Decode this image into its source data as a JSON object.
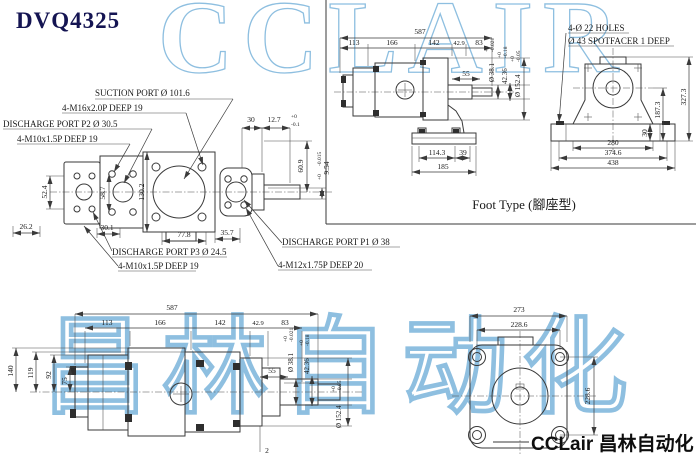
{
  "title": "DVQ4325",
  "watermarks": {
    "top": "CCLAIR",
    "bottom": "昌林自动化"
  },
  "brand": {
    "text": "CCLair 昌林自动化"
  },
  "colors": {
    "line": "#3a3a3a",
    "text": "#1a1a1a",
    "title": "#141452",
    "watermark": "#8ebfe0",
    "brand": "#0e0e0e"
  },
  "front_view": {
    "port_labels": {
      "suction": "SUCTION PORT Ø 101.6",
      "suction_bolts": "4-M16x2.0P DEEP 19",
      "p2": "DISCHARGE PORT P2 Ø 30.5",
      "p2_bolts": "4-M10x1.5P DEEP 19",
      "p3": "DISCHARGE PORT P3 Ø 24.5",
      "p3_bolts": "4-M10x1.5P DEEP 19",
      "p1": "DISCHARGE PORT P1 Ø 38",
      "p1_bolts": "4-M12x1.75P DEEP 20"
    },
    "dims": {
      "w52": "52.4",
      "w58": "58.7",
      "h130": "130.2",
      "w26": "26.2",
      "w30_1": "30.1",
      "w77": "77.8",
      "w35": "35.7",
      "len30": "30",
      "len12_7": "12.7",
      "tol12_hi": "+0",
      "tol12_lo": "-0.1",
      "h60": "60.9",
      "key9": "9.54",
      "tol9_hi": "+0",
      "tol9_lo": "-0.015"
    }
  },
  "foot_side_view": {
    "caption": "Foot Type (腳座型)",
    "dims": {
      "total": "587",
      "s1": "113",
      "s2": "166",
      "s3": "142",
      "s4": "42.9",
      "s5": "83",
      "shaft_len": "55",
      "base1": "114.3",
      "base2": "39",
      "base3": "185",
      "shaft_dia": "Ø 38.1",
      "shaft_dia_hi": "+0",
      "shaft_dia_lo": "-0.021",
      "key": "42.36",
      "key_hi": "+0",
      "key_lo": "-0.18",
      "spigot": "Ø 152.4",
      "spigot_hi": "+0",
      "spigot_lo": "-0.05"
    }
  },
  "foot_front_view": {
    "labels": {
      "holes": "4-Ø 22 HOLES",
      "spotface": "Ø 43 SPOTFACER 1 DEEP"
    },
    "dims": {
      "h327": "327.3",
      "h187": "187.3",
      "h30": "30",
      "w280": "280",
      "w374": "374.6",
      "w438": "438"
    }
  },
  "bottom_view": {
    "dims": {
      "total": "587",
      "s1": "113",
      "s2": "166",
      "s3": "142",
      "s4": "42.9",
      "s5": "83",
      "h140": "140",
      "h119": "119",
      "h92": "92",
      "h75": "75",
      "shaft_len": "55",
      "gap": "2",
      "shaft_dia": "Ø 38.1",
      "shaft_dia_hi": "+0",
      "shaft_dia_lo": "-0.021",
      "key": "42.36",
      "key_hi": "+0",
      "key_lo": "-0.18",
      "spigot": "Ø 152.4",
      "spigot_hi": "+0",
      "spigot_lo": "-0.05"
    }
  },
  "flange_view": {
    "dims": {
      "w273": "273",
      "w228": "228.6",
      "h228": "228.6"
    }
  }
}
